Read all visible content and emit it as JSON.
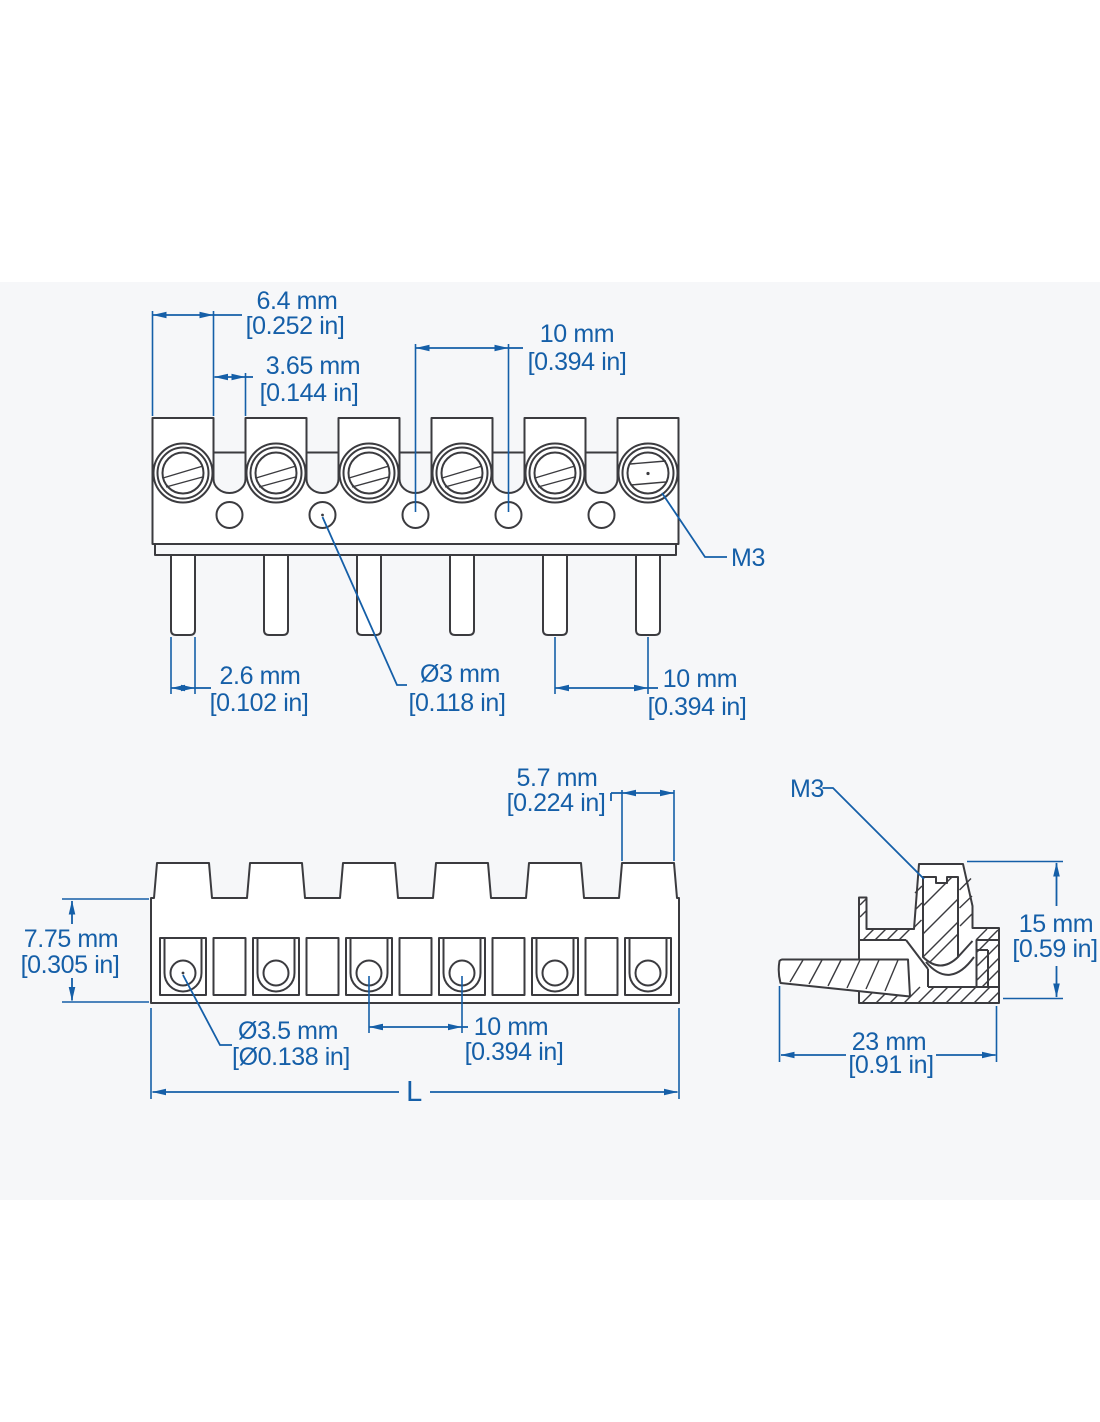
{
  "drawing": {
    "type": "terminal-block-dimension-drawing",
    "poles": 6,
    "colors": {
      "dimension_blue": "#155fa8",
      "part_line": "#3b3b3f",
      "panel_bg": "#f6f7f9",
      "page_bg": "#ffffff"
    },
    "labels": {
      "top": {
        "tower_w_mm": "6.4 mm",
        "tower_w_in": "[0.252 in]",
        "gap_mm": "3.65 mm",
        "gap_in": "[0.144 in]",
        "hole_pitch_mm": "10 mm",
        "hole_pitch_in": "[0.394 in]",
        "thread": "M3",
        "pin_w_mm": "2.6 mm",
        "pin_w_in": "[0.102 in]",
        "pin_d_mm": "Ø3 mm",
        "pin_d_in": "[0.118 in]",
        "pin_pitch_mm": "10 mm",
        "pin_pitch_in": "[0.394 in]"
      },
      "front": {
        "top_w_mm": "5.7 mm",
        "top_w_in": "[0.224 in]",
        "height_mm": "7.75 mm",
        "height_in": "[0.305 in]",
        "hole_d_mm": "Ø3.5 mm",
        "hole_d_in": "[Ø0.138 in]",
        "pitch_mm": "10 mm",
        "pitch_in": "[0.394 in]",
        "length": "L"
      },
      "section": {
        "thread": "M3",
        "height_mm": "15 mm",
        "height_in": "[0.59 in]",
        "depth_mm": "23 mm",
        "depth_in": "[0.91 in]"
      }
    }
  }
}
